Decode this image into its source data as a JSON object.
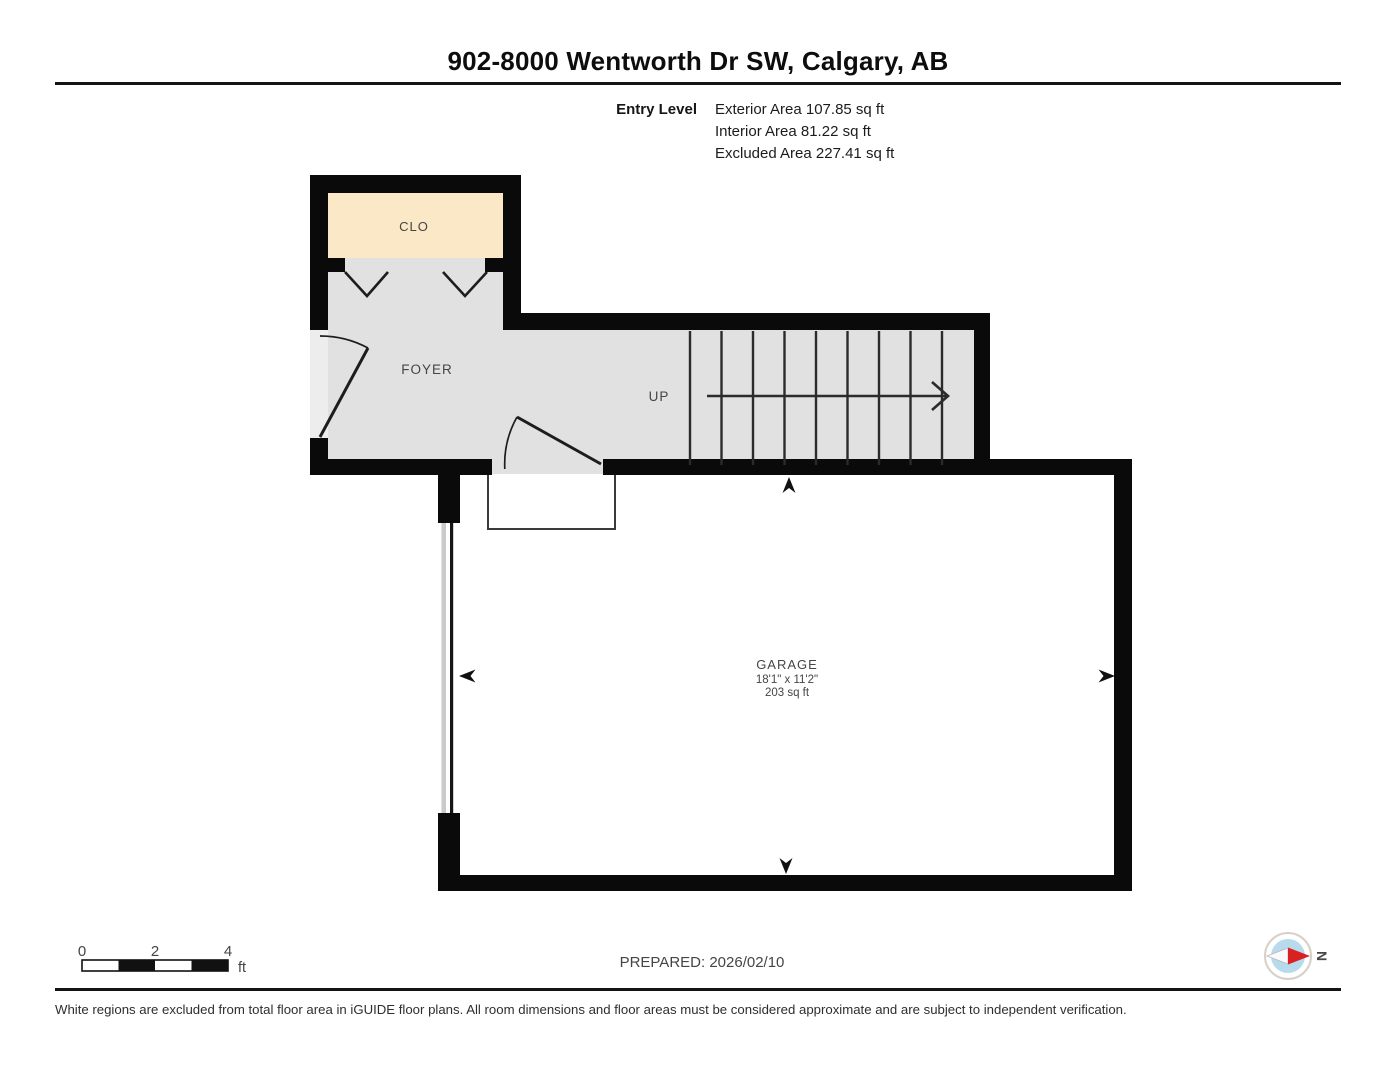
{
  "header": {
    "title": "902-8000 Wentworth Dr SW, Calgary, AB",
    "level_label": "Entry Level",
    "area_lines": [
      "Exterior Area 107.85 sq ft",
      "Interior Area 81.22 sq ft",
      "Excluded Area 227.41 sq ft"
    ]
  },
  "plan": {
    "rooms": {
      "closet": {
        "label": "CLO"
      },
      "foyer": {
        "label": "FOYER"
      },
      "garage": {
        "label": "GARAGE",
        "dimensions": "18'1\" x 11'2\"",
        "area": "203 sq ft"
      }
    },
    "stairs": {
      "direction_label": "UP"
    }
  },
  "footer": {
    "scale": {
      "ticks": [
        "0",
        "2",
        "4"
      ],
      "unit": "ft"
    },
    "prepared": "PREPARED: 2026/02/10",
    "compass": {
      "north_label": "N"
    },
    "disclaimer": "White regions are excluded from total floor area in iGUIDE floor plans. All room dimensions and floor areas must be considered approximate and are subject to independent verification."
  },
  "colors": {
    "wall": "#0a0a0a",
    "floor_fill": "#e1e1e1",
    "closet_fill": "#fbe8c7",
    "excluded_fill": "#ffffff",
    "compass_red": "#d92121",
    "compass_blue": "#b7daed"
  }
}
